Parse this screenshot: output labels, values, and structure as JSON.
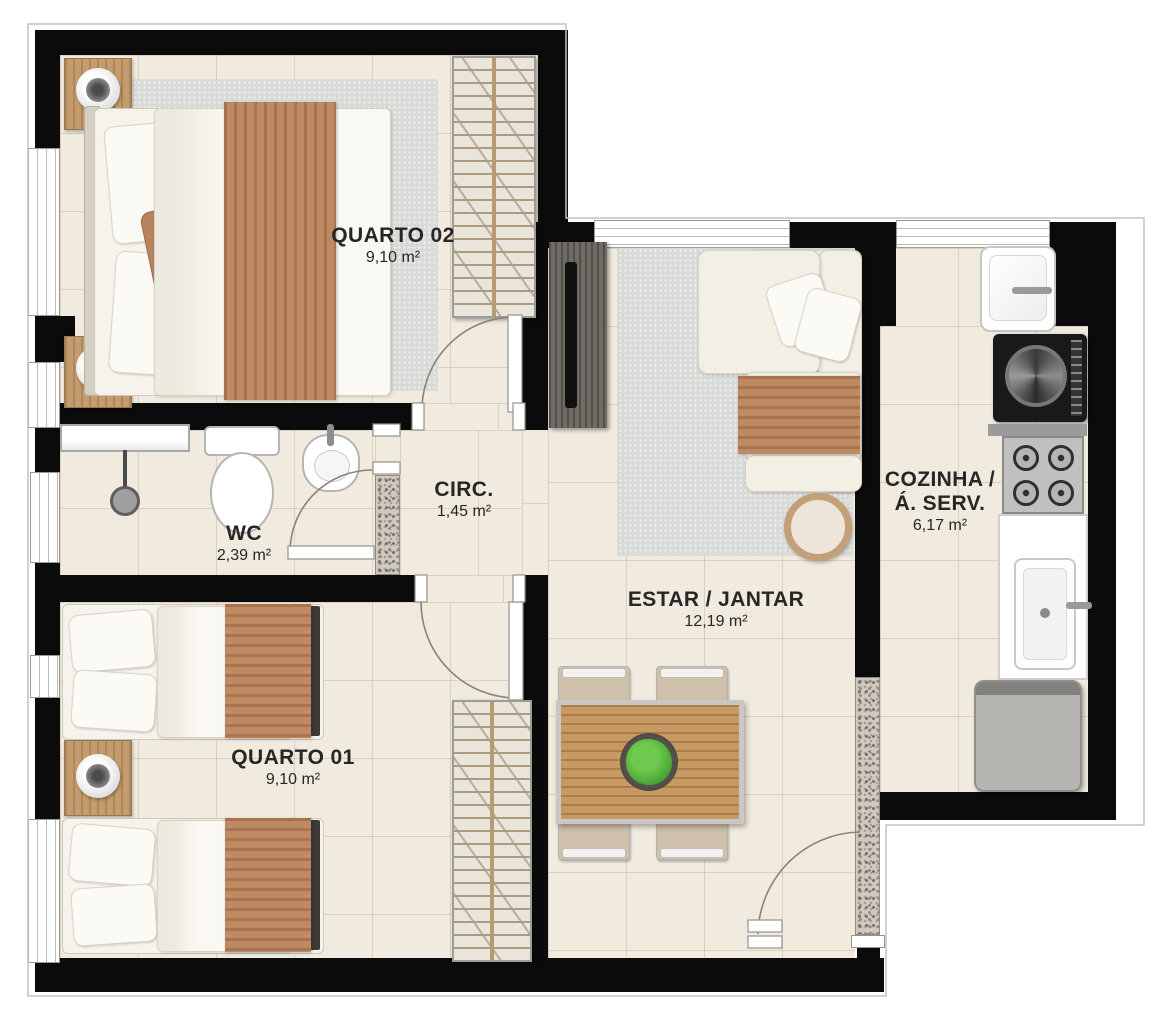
{
  "plan": {
    "rooms": {
      "quarto02": {
        "name": "QUARTO 02",
        "area": "9,10 m²"
      },
      "wc": {
        "name": "WC",
        "area": "2,39 m²"
      },
      "circ": {
        "name": "CIRC.",
        "area": "1,45 m²"
      },
      "estar": {
        "name": "ESTAR / JANTAR",
        "area": "12,19 m²"
      },
      "cozinha": {
        "name_line1": "COZINHA /",
        "name_line2": "Á. SERV.",
        "area": "6,17 m²"
      },
      "quarto01": {
        "name": "QUARTO 01",
        "area": "9,10 m²"
      }
    },
    "colors": {
      "wall": "#0b0b0b",
      "floor": "#f0eadf",
      "rug": "#d8dad8",
      "wood": "#c59c6d",
      "throw_blanket": "#bd8a64",
      "sofa": "#f2efe5",
      "plant": "#4aa838",
      "granite": "#cfc9c0"
    }
  }
}
